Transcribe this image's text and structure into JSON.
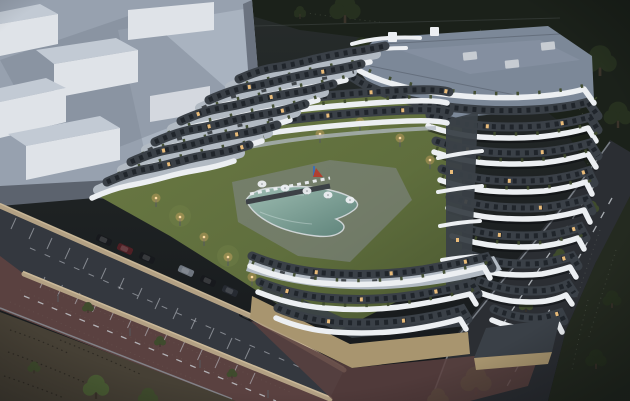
{
  "scene": {
    "type": "architectural-render",
    "setting": "aerial dusk view of a modern white apartment complex with terraced curved balconies",
    "features": [
      "wavy white balcony bands",
      "rooftop terraces with planters",
      "gray flat roof",
      "courtyard lawn",
      "curved swimming pool",
      "sun loungers",
      "white parasols",
      "small playground",
      "warm path lights",
      "walled parking lot with cars",
      "beige perimeter walls",
      "brick paved road",
      "asphalt road with lane dashes",
      "street trees",
      "dark scrubland",
      "abstract gray neighbour building massing"
    ],
    "time_of_day": "dusk",
    "lighting": "warm interior and path lights against blue-gray dusk"
  },
  "counts": {
    "visible_cars": 8,
    "parasols": 5,
    "path_lights": 9,
    "parking_trees": 3,
    "street_trees": 6,
    "visible_floor_bands": 14
  },
  "colors": {
    "sky_top": "#272c2b",
    "sky_bottom": "#15181b",
    "scrub": "#242a20",
    "scrub_dark": "#1b211a",
    "tree_dark": "#26301f",
    "tree_mid": "#3f4b2d",
    "tree_light": "#4a5c34",
    "massing_face": "#97a1af",
    "massing_roof": "#a9b3c0",
    "massing_shadow": "#7e8795",
    "massing_wall_dark": "#6b7380",
    "massing_block": "#dfe3e8",
    "massing_block_top": "#c2cad4",
    "apron": "#5c636e",
    "band_white": "#eceff2",
    "deck_light": "#b2bac3",
    "deck_dark": "#3c4146",
    "facade_dark": "#3a4047",
    "window_dark": "#20252b",
    "window_lit": "#f3c37d",
    "roof_gray": "#7c8898",
    "roof_light": "#8f9aab",
    "ac_gray": "#c7ccd2",
    "lawn": "#5f6e3d",
    "lawn_dark": "#49562f",
    "lawn_light": "#75834a",
    "pool_light": "#9dbcb1",
    "pool_dark": "#5d8279",
    "pool_rim": "#d8dde0",
    "pool_deck": "#84898d",
    "asphalt": "#34383f",
    "parking_mark": "#c6cbd1",
    "wall_beige": "#b3a184",
    "wall_beige_light": "#cdbb9b",
    "podium_beige": "#a8956f",
    "brick": "#5a4140",
    "brick_light": "#6b4c47",
    "road_dark": "#2b2e33",
    "road_mark": "#c9ced3",
    "curb": "#8b9199",
    "dirt": "#464035",
    "warm_glow": "#ffbe72",
    "warm_core": "#ffdca2",
    "car_black": "#17191d",
    "car_gray": "#6e757e",
    "car_maroon": "#4f1f24",
    "car_dark": "#262a31",
    "play_blue": "#3f6fb0",
    "play_red": "#b04030"
  }
}
